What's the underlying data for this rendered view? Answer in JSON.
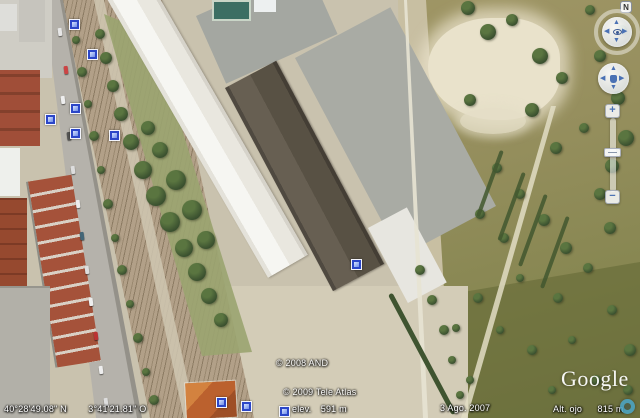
{
  "window": {
    "width": 640,
    "height": 418,
    "app": "Google Earth satellite view"
  },
  "status_bar": {
    "latitude": "40°28'49.08\" N",
    "longitude": "3°41'21.81\" O",
    "elevation_label": "elev.",
    "elevation_value": "591 m",
    "imagery_date": "3 Ago. 2007",
    "eye_altitude_label": "Alt. ojo",
    "eye_altitude_value": "815 m"
  },
  "attribution": {
    "copyright_and": "© 2008 AND",
    "copyright_tele_atlas": "© 2009 Tele Atlas",
    "logo_text": "Google"
  },
  "icons": {
    "north": "N",
    "zoom_in": "+",
    "zoom_out": "−",
    "pan_up": "▲",
    "pan_down": "▼",
    "pan_left": "◀",
    "pan_right": "▶"
  },
  "colors": {
    "photo_marker_blue": "#2b46c8",
    "streaming_indicator_teal": "#4fa8c8",
    "nav_arrow_blue": "#4a71b4"
  },
  "map": {
    "photo_markers": [
      {
        "x": 73,
        "y": 23
      },
      {
        "x": 91,
        "y": 53
      },
      {
        "x": 74,
        "y": 107
      },
      {
        "x": 49,
        "y": 118
      },
      {
        "x": 74,
        "y": 132
      },
      {
        "x": 113,
        "y": 134
      },
      {
        "x": 355,
        "y": 263
      },
      {
        "x": 220,
        "y": 401
      },
      {
        "x": 245,
        "y": 405
      },
      {
        "x": 283,
        "y": 410
      }
    ]
  }
}
